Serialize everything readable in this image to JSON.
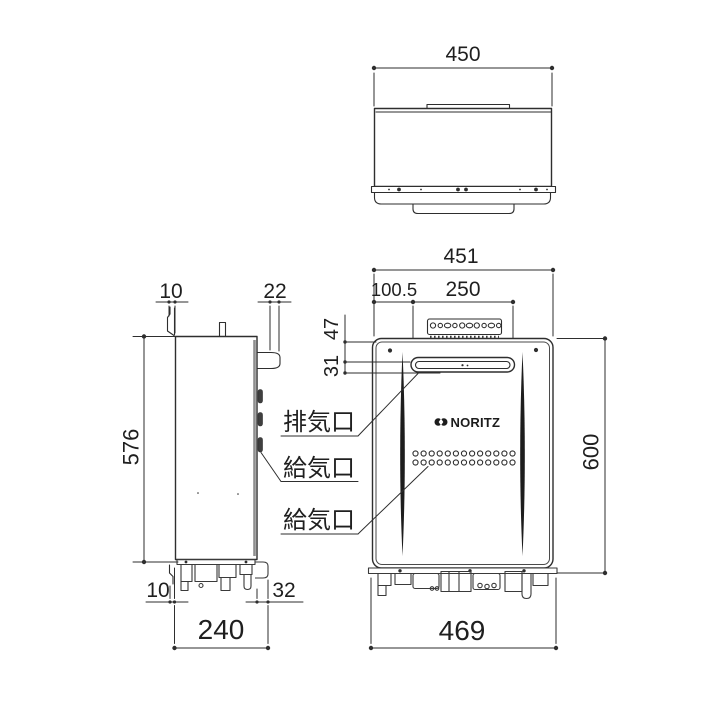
{
  "drawing": {
    "title": "gas-water-heater-dimension-drawing",
    "ink_color": "#2e2e2e",
    "background": "#ffffff",
    "brand": "NORITZ",
    "top_view": {
      "width": "450"
    },
    "side_view": {
      "top_back_gap": "10",
      "top_front_protrusion": "22",
      "body_height": "576",
      "bottom_back_gap": "10",
      "bottom_front_protrusion": "32",
      "total_depth": "240"
    },
    "front_view": {
      "total_width": "451",
      "exhaust_offset": "100.5",
      "exhaust_width": "250",
      "exhaust_top_offset": "47",
      "exhaust_height": "31",
      "body_height": "600",
      "bottom_width": "469"
    },
    "port_labels": {
      "exhaust": "排気口",
      "intake_side": "給気口",
      "intake_front": "給気口"
    }
  }
}
